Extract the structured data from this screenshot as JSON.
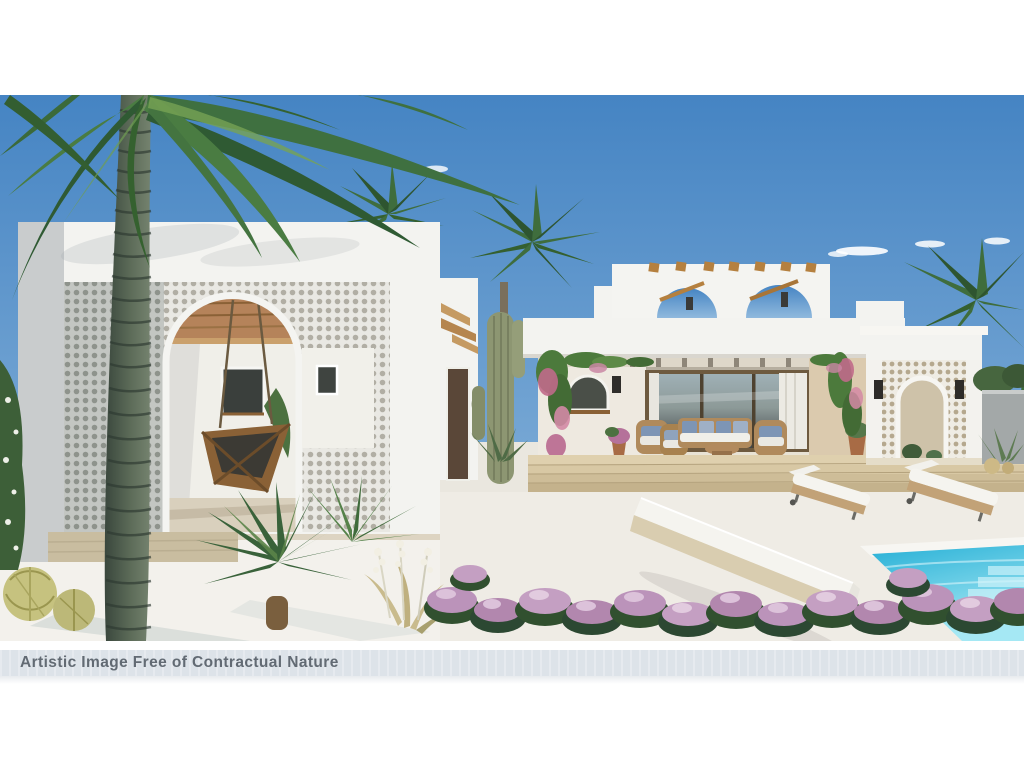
{
  "caption": {
    "text": "Artistic Image Free of Contractual Nature"
  },
  "scene": {
    "description": "3D architectural rendering: white Ibiza-style villa with perforated celosia walls, arched openings, rooftop arch pergola, hanging swing chair, saguaro cactus, palm trees, sun loungers, long white day-bed, turquoise pool corner and pink heather garden under a blue sky",
    "colors": {
      "sky_top": "#4584c3",
      "sky_bottom": "#90b9dd",
      "cloud": "#ffffff",
      "white_wall": "#f3f3f0",
      "wall_shade": "#c9cccd",
      "screen_base": "#e9e8e3",
      "screen_hole": "#b1aea4",
      "screen_shade_base": "#c3c6c2",
      "screen_shade_hole": "#8e938c",
      "porch_shadow": "#b9b1a3",
      "porch_floor": "#e9e3d5",
      "warm_wall": "#dbcaae",
      "wood": "#c08d57",
      "wood_dark": "#8a6136",
      "glass_light": "#9fb0b6",
      "glass_dark": "#3e4346",
      "curtain": "#eceae3",
      "trunk_light": "#75836f",
      "trunk_dark": "#3a473d",
      "trunk_ring": "#2d3931",
      "frond_dark": "#2f5a33",
      "frond_mid": "#4a7c42",
      "frond_light": "#6f9d52",
      "cactus": "#8d9672",
      "cactus_rib": "#6a7355",
      "stone_step": "#dfd0ae",
      "stone_step_dark": "#c3b18b",
      "plinth": "#c9bda0",
      "pavement": "#ddd4c2",
      "gravel": "#f3f1ec",
      "patio": "#eae7df",
      "pool_top": "#27b0d6",
      "pool_bottom": "#a5e8f4",
      "pool_coping": "#f7f6f2",
      "heather_pink": "#bb93ba",
      "heather_light": "#dcc2da",
      "heather_green": "#31502f",
      "cushion": "#f5f4ef",
      "wicker": "#bd9a6b",
      "pillow_blue": "#7d95b5",
      "terracotta": "#a86b45",
      "bench_base": "#d9cdb0",
      "gray_wall": "#a3a8a8",
      "hedge": "#47663f",
      "lantern": "#2e2c29",
      "caption_band": "#dde3e9",
      "caption_text": "#4d565f",
      "page_background": "#ffffff"
    }
  }
}
